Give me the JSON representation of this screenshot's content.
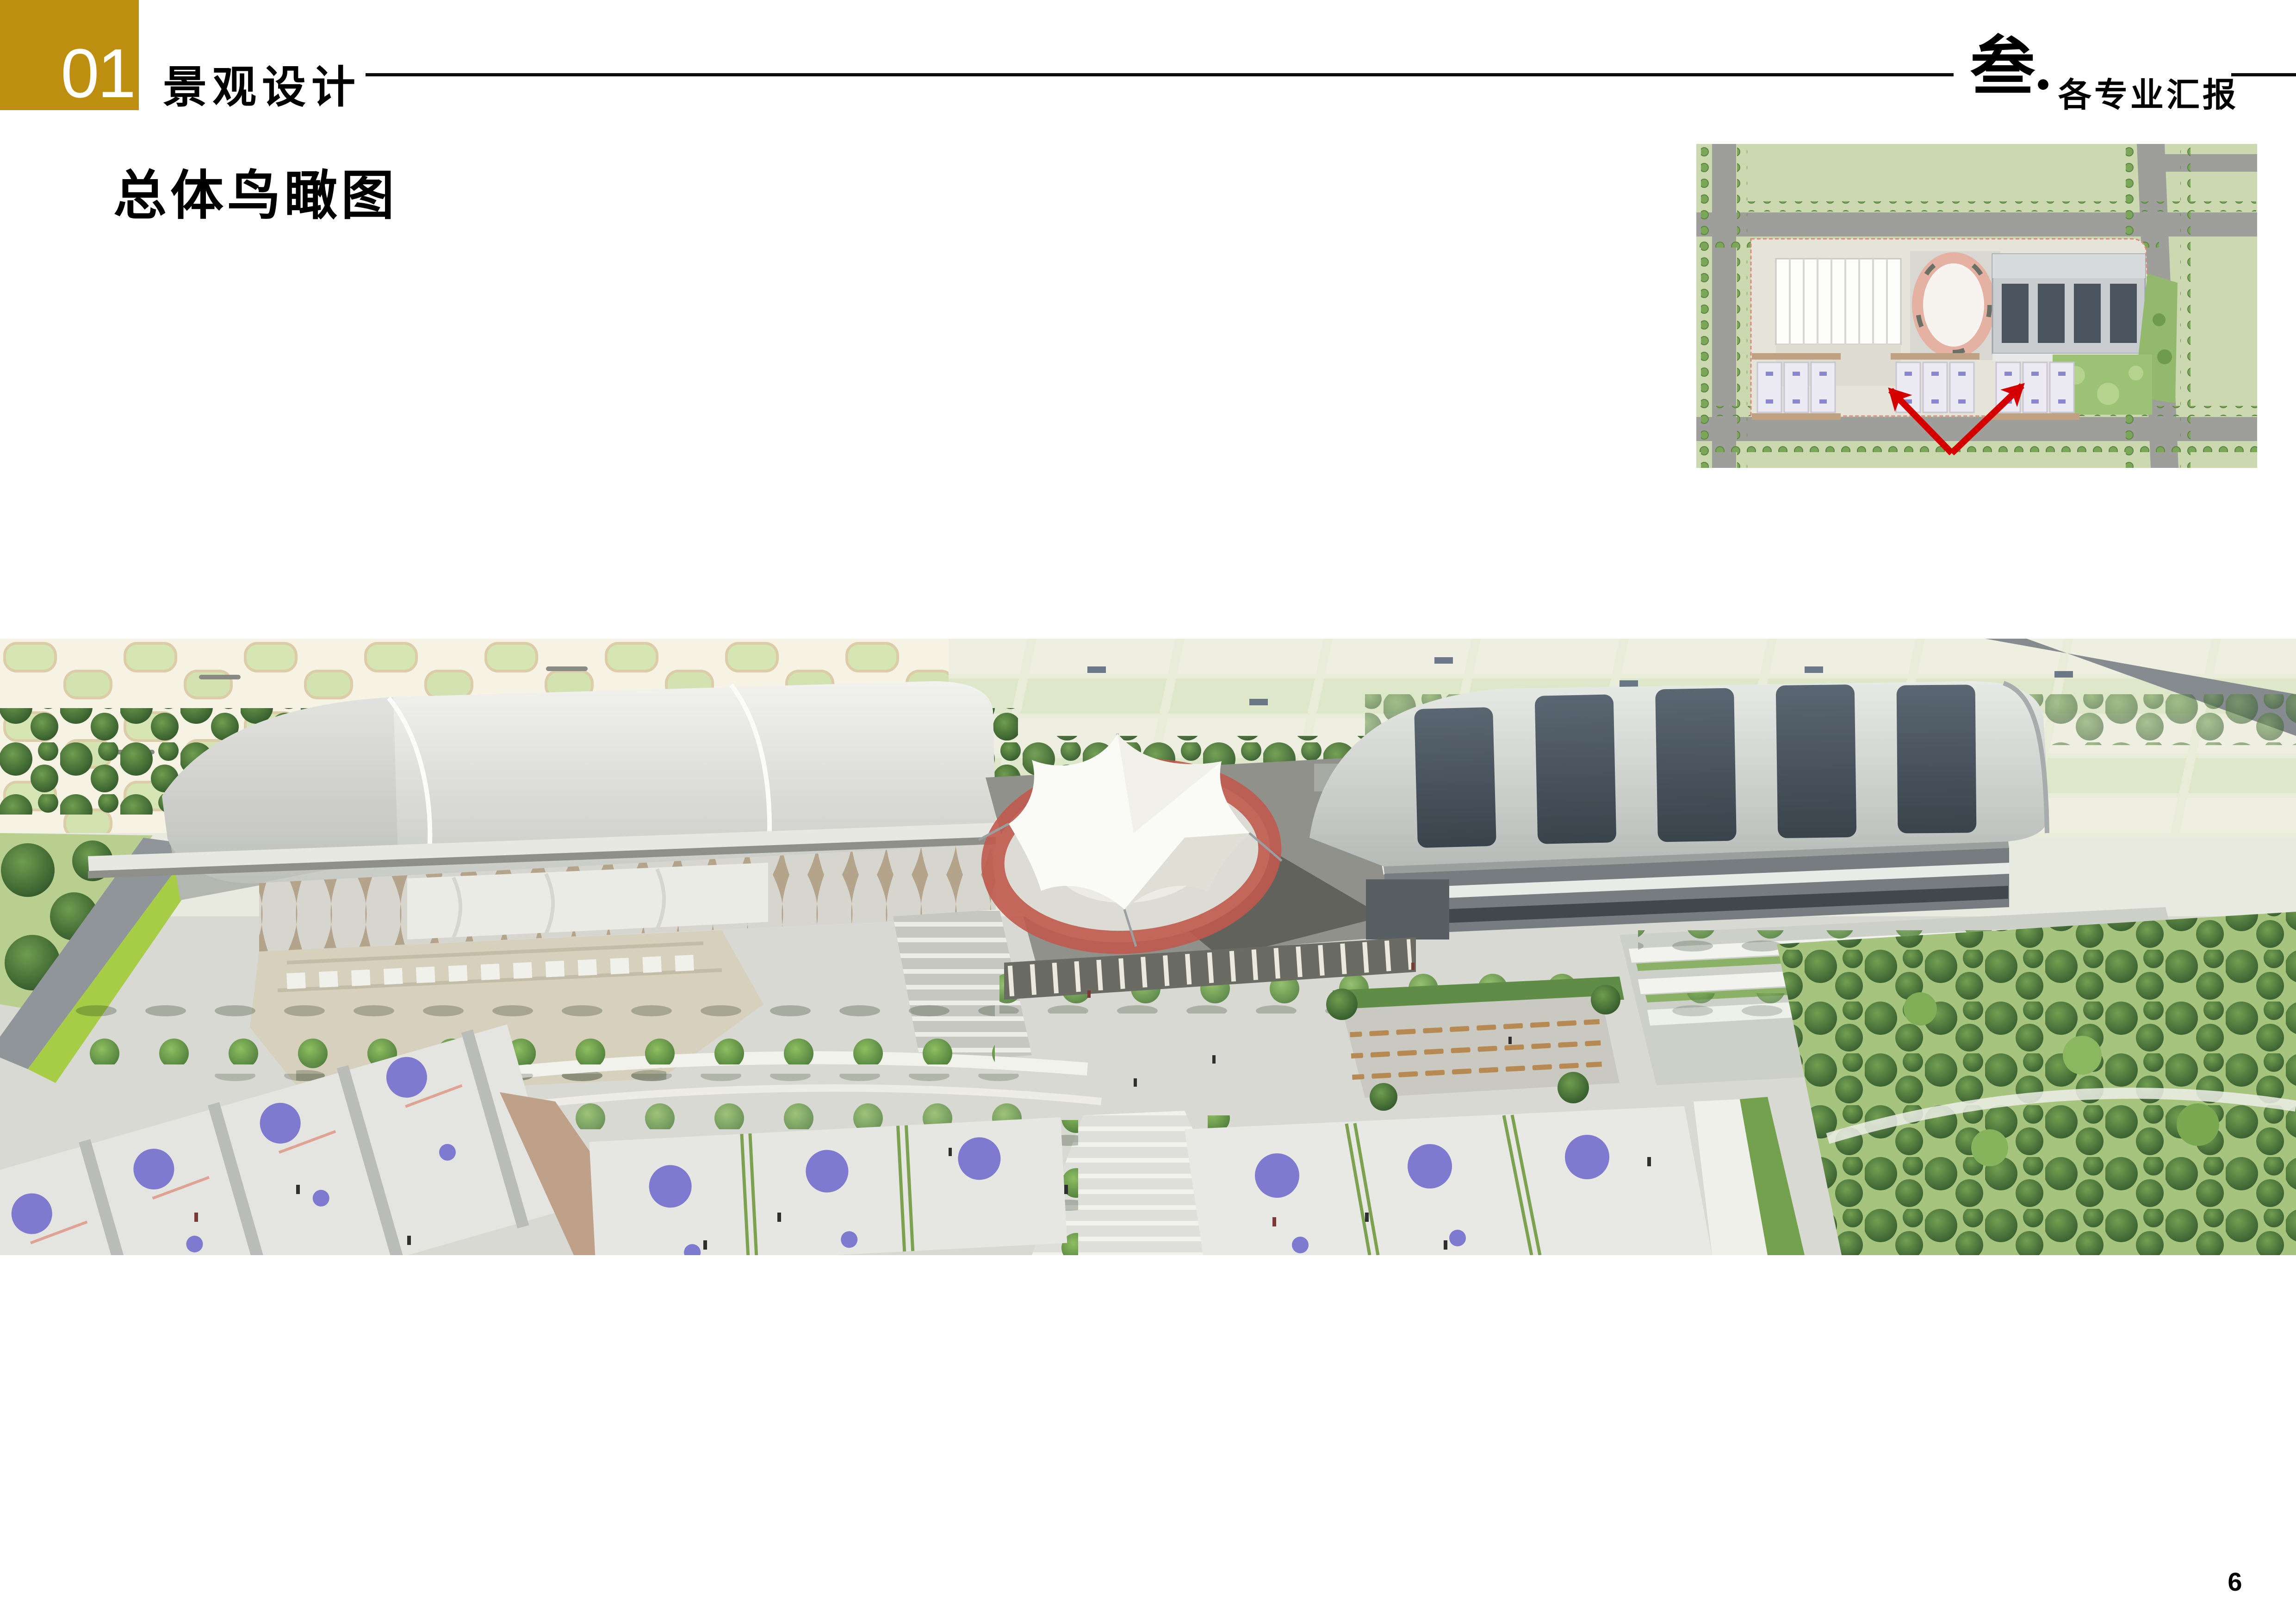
{
  "header": {
    "section_number": "01",
    "section_label": "景观设计",
    "chapter_number": "叁.",
    "chapter_label": "各专业汇报"
  },
  "content": {
    "title": "总体鸟瞰图"
  },
  "footer": {
    "page_number": "6"
  },
  "colors": {
    "accent_gold": "#BE8E11",
    "arrow_red": "#D40000",
    "court_violet": "#7D7AD0",
    "track_red": "#C05A4E",
    "foliage_green": "#3A652F"
  }
}
